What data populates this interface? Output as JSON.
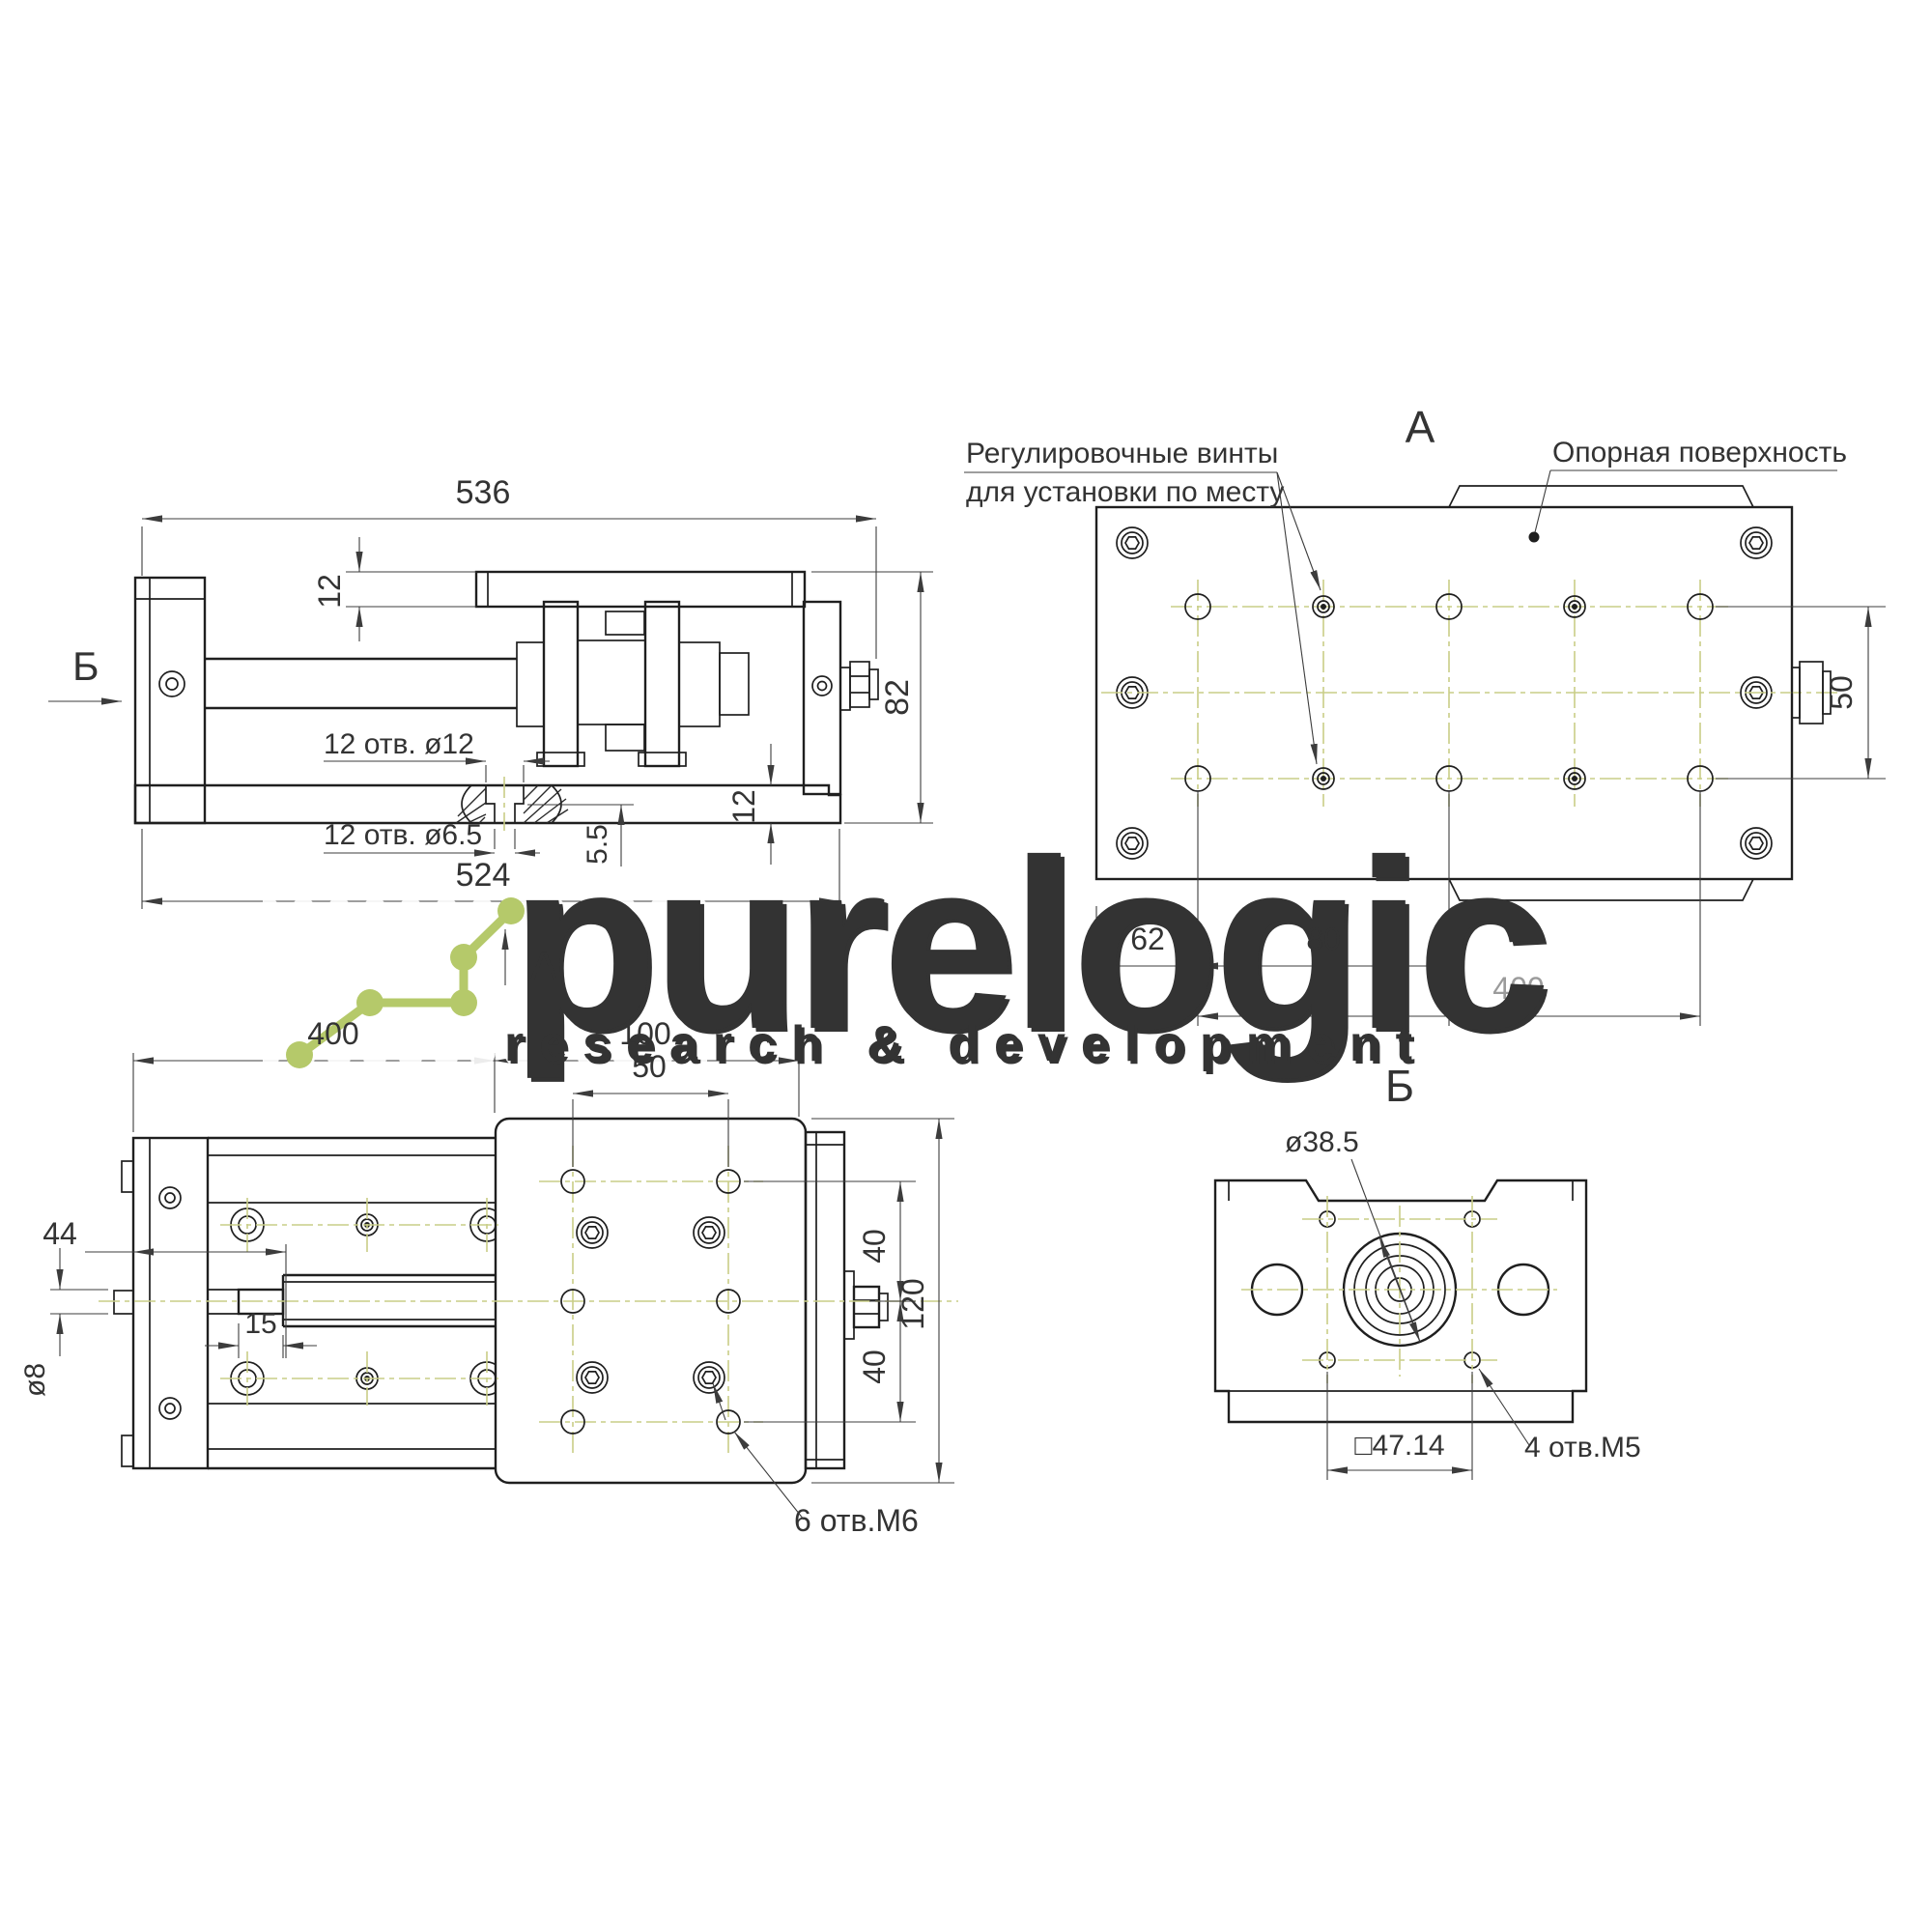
{
  "watermark": {
    "brand": "purelogic",
    "tagline": "research & development"
  },
  "side_view": {
    "marker_b": "Б",
    "marker_a": "А",
    "dim_total_length": "536",
    "dim_plate_thickness": "12",
    "dim_height": "82",
    "label_holes_top": "12 отв. ø12",
    "label_holes_bottom": "12 отв. ø6.5",
    "dim_counterbore_depth": "5.5",
    "dim_base_thickness": "12",
    "dim_base_length": "524"
  },
  "view_a": {
    "title": "А",
    "label_adjust_screws_1": "Регулировочные винты",
    "label_adjust_screws_2": "для установки по месту",
    "label_support_surface": "Опорная поверхность",
    "dim_row_spacing": "50",
    "dim_edge_offset": "62",
    "dim_hole_pitch": "80",
    "dim_hole_span": "400"
  },
  "plan_view": {
    "dim_travel": "400",
    "dim_carriage_length": "100",
    "dim_hole_pitch": "50",
    "dim_shaft_length": "44",
    "dim_shaft_step": "15",
    "dim_shaft_dia": "ø8",
    "dim_row_top": "40",
    "dim_width": "120",
    "dim_row_bottom": "40",
    "label_holes": "6 отв.М6"
  },
  "view_b": {
    "title": "Б",
    "dim_pilot_dia": "ø38.5",
    "dim_square": "□47.14",
    "label_holes": "4 отв.М5"
  },
  "colors": {
    "line": "#1f1f1f",
    "dimension": "#3c3c3c",
    "centerline": "#c9cd87",
    "logo_green": "#b5c96a"
  }
}
